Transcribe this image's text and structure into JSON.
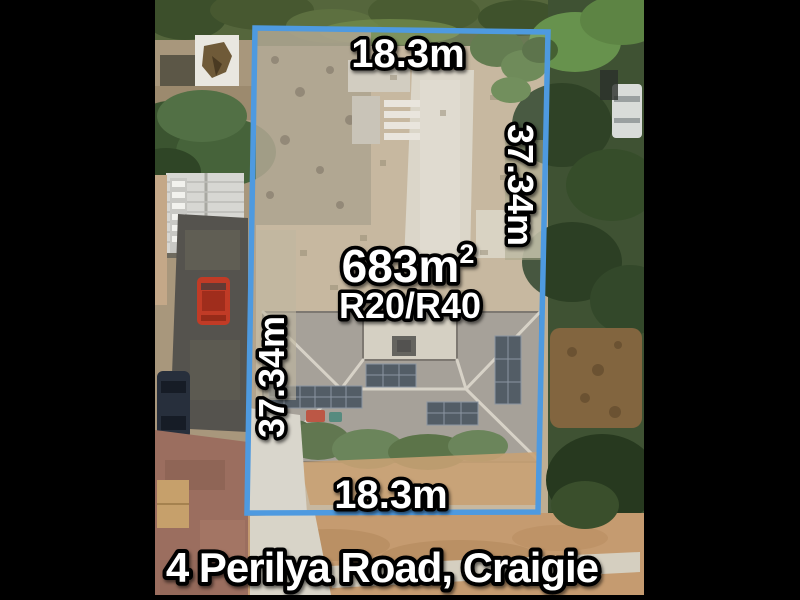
{
  "scene": {
    "description": "Aerial satellite photo of a residential lot with blue survey boundary overlay and dimension labels",
    "background_color": "#000000"
  },
  "colors": {
    "boundary": "#4e9ae0",
    "label_fill": "#ffffff",
    "label_outline": "#000000"
  },
  "labels": {
    "top_width": "18.3m",
    "bottom_width": "18.3m",
    "left_depth": "37.34m",
    "right_depth": "37.34m",
    "area_value": "683m",
    "area_superscript": "2",
    "zoning": "R20/R40",
    "address": "4 Perilya Road, Craigie"
  }
}
